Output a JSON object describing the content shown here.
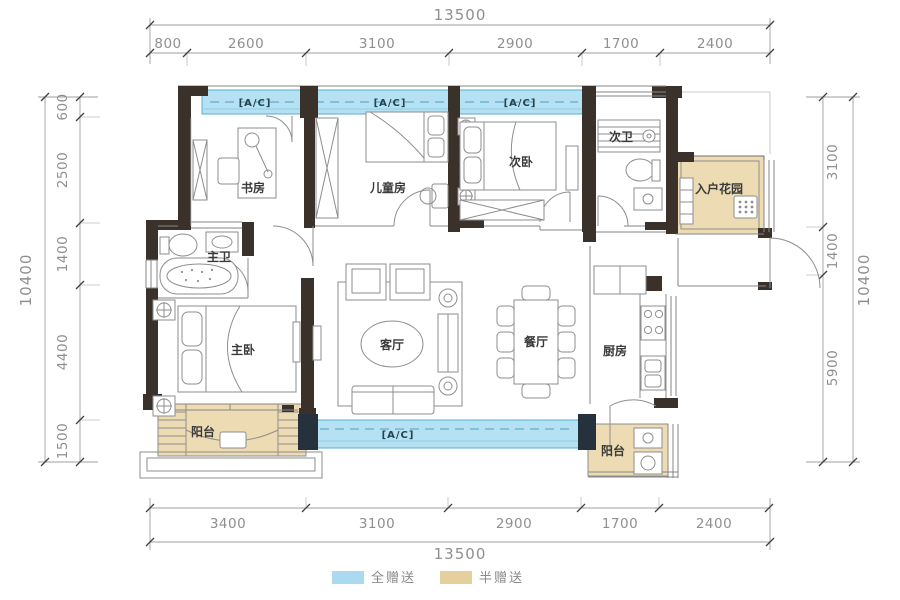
{
  "title": "户型图",
  "rooms": {
    "study": "书房",
    "kids_room": "儿童房",
    "second_bedroom": "次卧",
    "second_bath": "次卫",
    "entry_garden": "入户花园",
    "master_bath": "主卫",
    "master_bedroom": "主卧",
    "living_room": "客厅",
    "dining_room": "餐厅",
    "kitchen": "厨房",
    "balcony_left": "阳台",
    "balcony_right": "阳台"
  },
  "ac": {
    "label": "[A/C]"
  },
  "dimensions": {
    "top_total": "13500",
    "top_segments": [
      "800",
      "2600",
      "3100",
      "2900",
      "1700",
      "2400"
    ],
    "bottom_total": "13500",
    "bottom_segments": [
      "3400",
      "3100",
      "2900",
      "1700",
      "2400"
    ],
    "left_total": "10400",
    "left_segments": [
      "600",
      "2500",
      "1400",
      "4400",
      "1500"
    ],
    "right_total": "10400",
    "right_segments": [
      "3100",
      "1400",
      "5900"
    ]
  },
  "legend": {
    "items": [
      {
        "label": "全赠送",
        "color": "#a9daef"
      },
      {
        "label": "半赠送",
        "color": "#e4cf9d"
      }
    ]
  },
  "colors": {
    "wall": "#3a312b",
    "ac_zone_fill": "#b5e1f3",
    "ac_zone_border": "#55aed2",
    "half_gift_fill": "#eddcb3",
    "dimension_text": "#8f8f8f"
  }
}
